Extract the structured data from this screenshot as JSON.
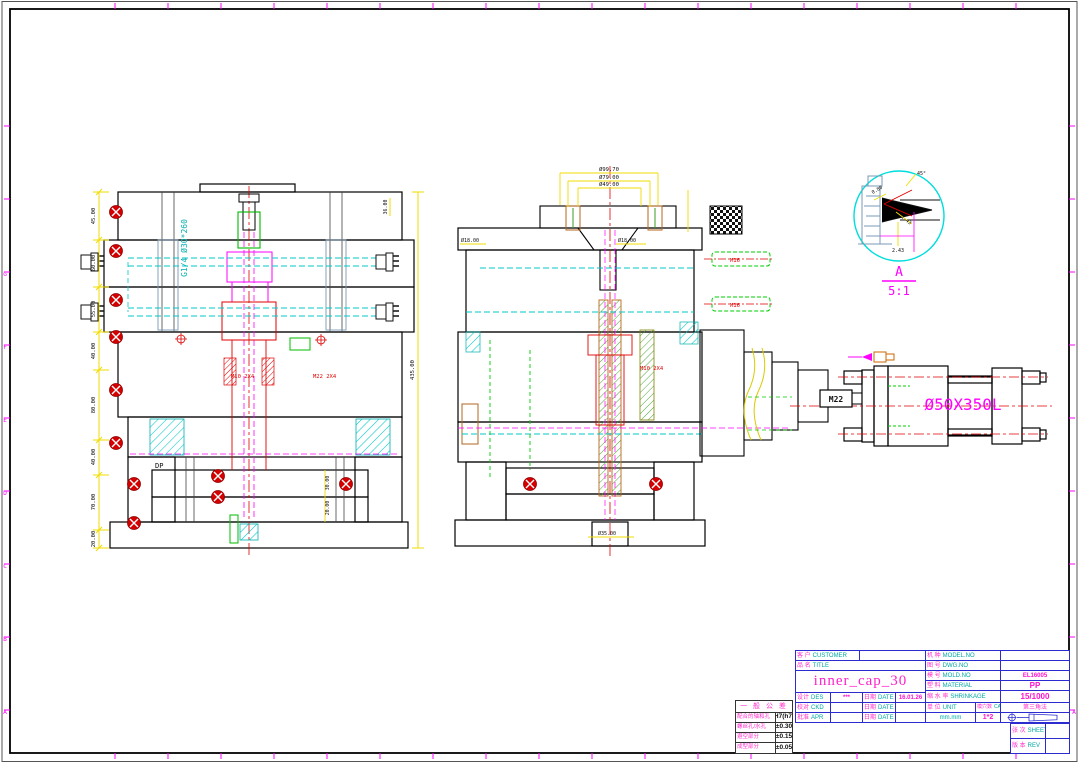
{
  "sheet": {
    "edu_stamp": "由 Autodesk 教育版产品制作",
    "zone_letters_left": [
      "G",
      "F",
      "E",
      "D",
      "C",
      "B",
      "A"
    ],
    "zone_letter_right": "A"
  },
  "left_view": {
    "dims_left": [
      "45.00",
      "60.00",
      "55.00",
      "40.00",
      "80.00",
      "40.00",
      "70.00",
      "20.00"
    ],
    "dim_right_total": "435.00",
    "dim_top_right": "36.00",
    "dim_ej_1": "30.00",
    "dim_ej_2": "20.00",
    "water_spec": "G1/4 Ø30*260",
    "label_dp": "DP",
    "label_m10": "M10 2X4",
    "label_m22": "M22 2X4"
  },
  "right_view": {
    "dim_top_1": "Ø99.70",
    "dim_top_2": "Ø79.00",
    "dim_top_3": "Ø49.00",
    "dim_left": "Ø18.00",
    "dim_mid": "Ø18.00",
    "dim_bottom": "Ø35.00",
    "label_m16_1": "M16",
    "label_m16_2": "M16",
    "label_m10": "M10 2X4"
  },
  "detail_a": {
    "name": "A",
    "scale": "5:1",
    "dim_angle": "45°",
    "dim_1": "0.80",
    "dim_2": "1.43",
    "dim_3": "2.43"
  },
  "cylinder": {
    "size_label": "Ø50X350L",
    "coupler_label": "M22"
  },
  "title_block": {
    "customer": {
      "zh": "客 户",
      "en": "CUSTOMER",
      "value": ""
    },
    "part": {
      "zh": "品 名",
      "en": "TITLE",
      "value": "inner_cap_30"
    },
    "designer": {
      "zh": "设计",
      "en": "DES",
      "value": "***"
    },
    "checker": {
      "zh": "校对",
      "en": "CKD",
      "value": ""
    },
    "approver": {
      "zh": "批准",
      "en": "APR",
      "value": ""
    },
    "date_zh": "日期",
    "date_en": "DATE",
    "design_date": "16.01.26",
    "check_date": "",
    "approve_date": "",
    "model": {
      "zh": "机 种",
      "en": "MODEL.NO",
      "value": ""
    },
    "dwg": {
      "zh": "图 号",
      "en": "DWG.NO",
      "value": ""
    },
    "mold": {
      "zh": "模 号",
      "en": "MOLD.NO",
      "value": "EL16005"
    },
    "material": {
      "zh": "塑 料",
      "en": "MATERIAL",
      "value": "PP"
    },
    "shrinkage": {
      "zh": "缩 水 率",
      "en": "SHRINKAGE",
      "value": "15/1000"
    },
    "unit": {
      "zh": "单 位",
      "en": "UNIT",
      "value": "mm.mm"
    },
    "cavity": {
      "zh": "模穴数",
      "en": "CAVI.NO",
      "value": "1*2"
    },
    "projection": "第三角法",
    "sheet": {
      "zh": "张 次",
      "en": "SHEET",
      "value": ""
    },
    "rev": {
      "zh": "版 本",
      "en": "REV",
      "value": ""
    }
  },
  "tolerance_table": {
    "header": "一 般 公 差",
    "rows": [
      {
        "label": "配合的轴和孔",
        "value": "H7(h7)"
      },
      {
        "label": "螺丝孔/水孔",
        "value": "±0.30"
      },
      {
        "label": "避空部分",
        "value": "±0.15"
      },
      {
        "label": "成型部分",
        "value": "±0.05"
      }
    ]
  }
}
